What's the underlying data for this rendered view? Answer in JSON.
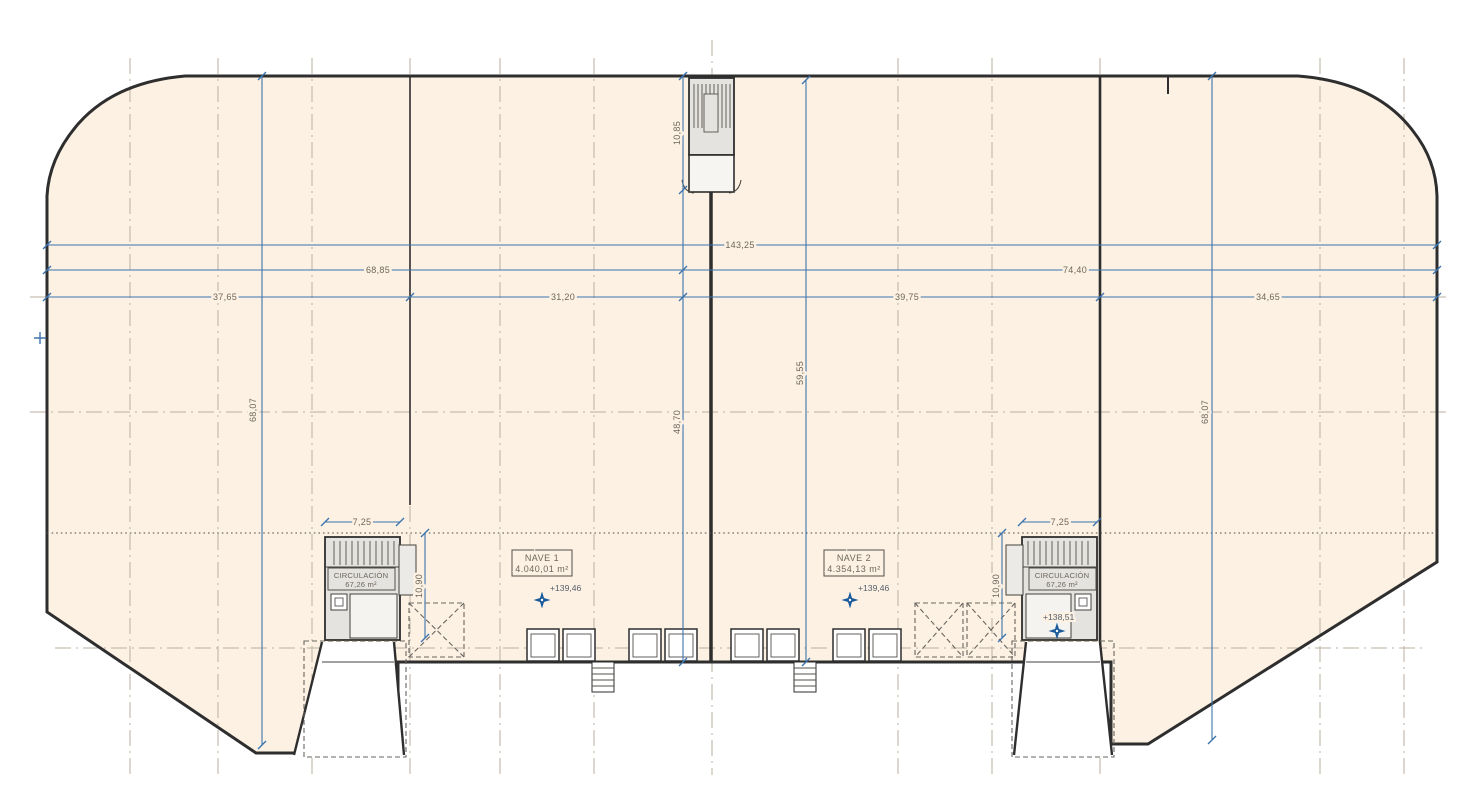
{
  "drawing": {
    "type": "architectural-floor-plan",
    "rooms": {
      "nave1": {
        "name": "NAVE 1",
        "area": "4.040,01 m²",
        "level": "+139,46"
      },
      "nave2": {
        "name": "NAVE 2",
        "area": "4.354,13 m²",
        "level": "+139,46"
      },
      "circulation_left": {
        "name": "CIRCULACIÓN",
        "area": "67,26 m²"
      },
      "circulation_right": {
        "name": "CIRCULACIÓN",
        "area": "67,26 m²",
        "level": "+138,51"
      }
    },
    "dims": {
      "total_width": "143,25",
      "left_span": "68,85",
      "right_span": "74,40",
      "bay_a": "37,65",
      "bay_b": "31,20",
      "bay_c": "39,75",
      "bay_d": "34,65",
      "depth_left": "68,07",
      "depth_right": "68,07",
      "depth_center": "48,70",
      "depth_nave2": "59,55",
      "top_core_depth": "10,85",
      "core_left_width": "7,25",
      "core_right_width": "7,25",
      "core_left_depth": "10,90",
      "core_right_depth": "10,90"
    },
    "colors": {
      "paper": "#ffffff",
      "building_fill": "#fcf1e3",
      "wall": "#2e2e2e",
      "dimension_blue": "#3d74ae",
      "grid": "#b9b1a2",
      "label_text": "#6e675c",
      "level_marker": "#1d5c9c"
    }
  }
}
